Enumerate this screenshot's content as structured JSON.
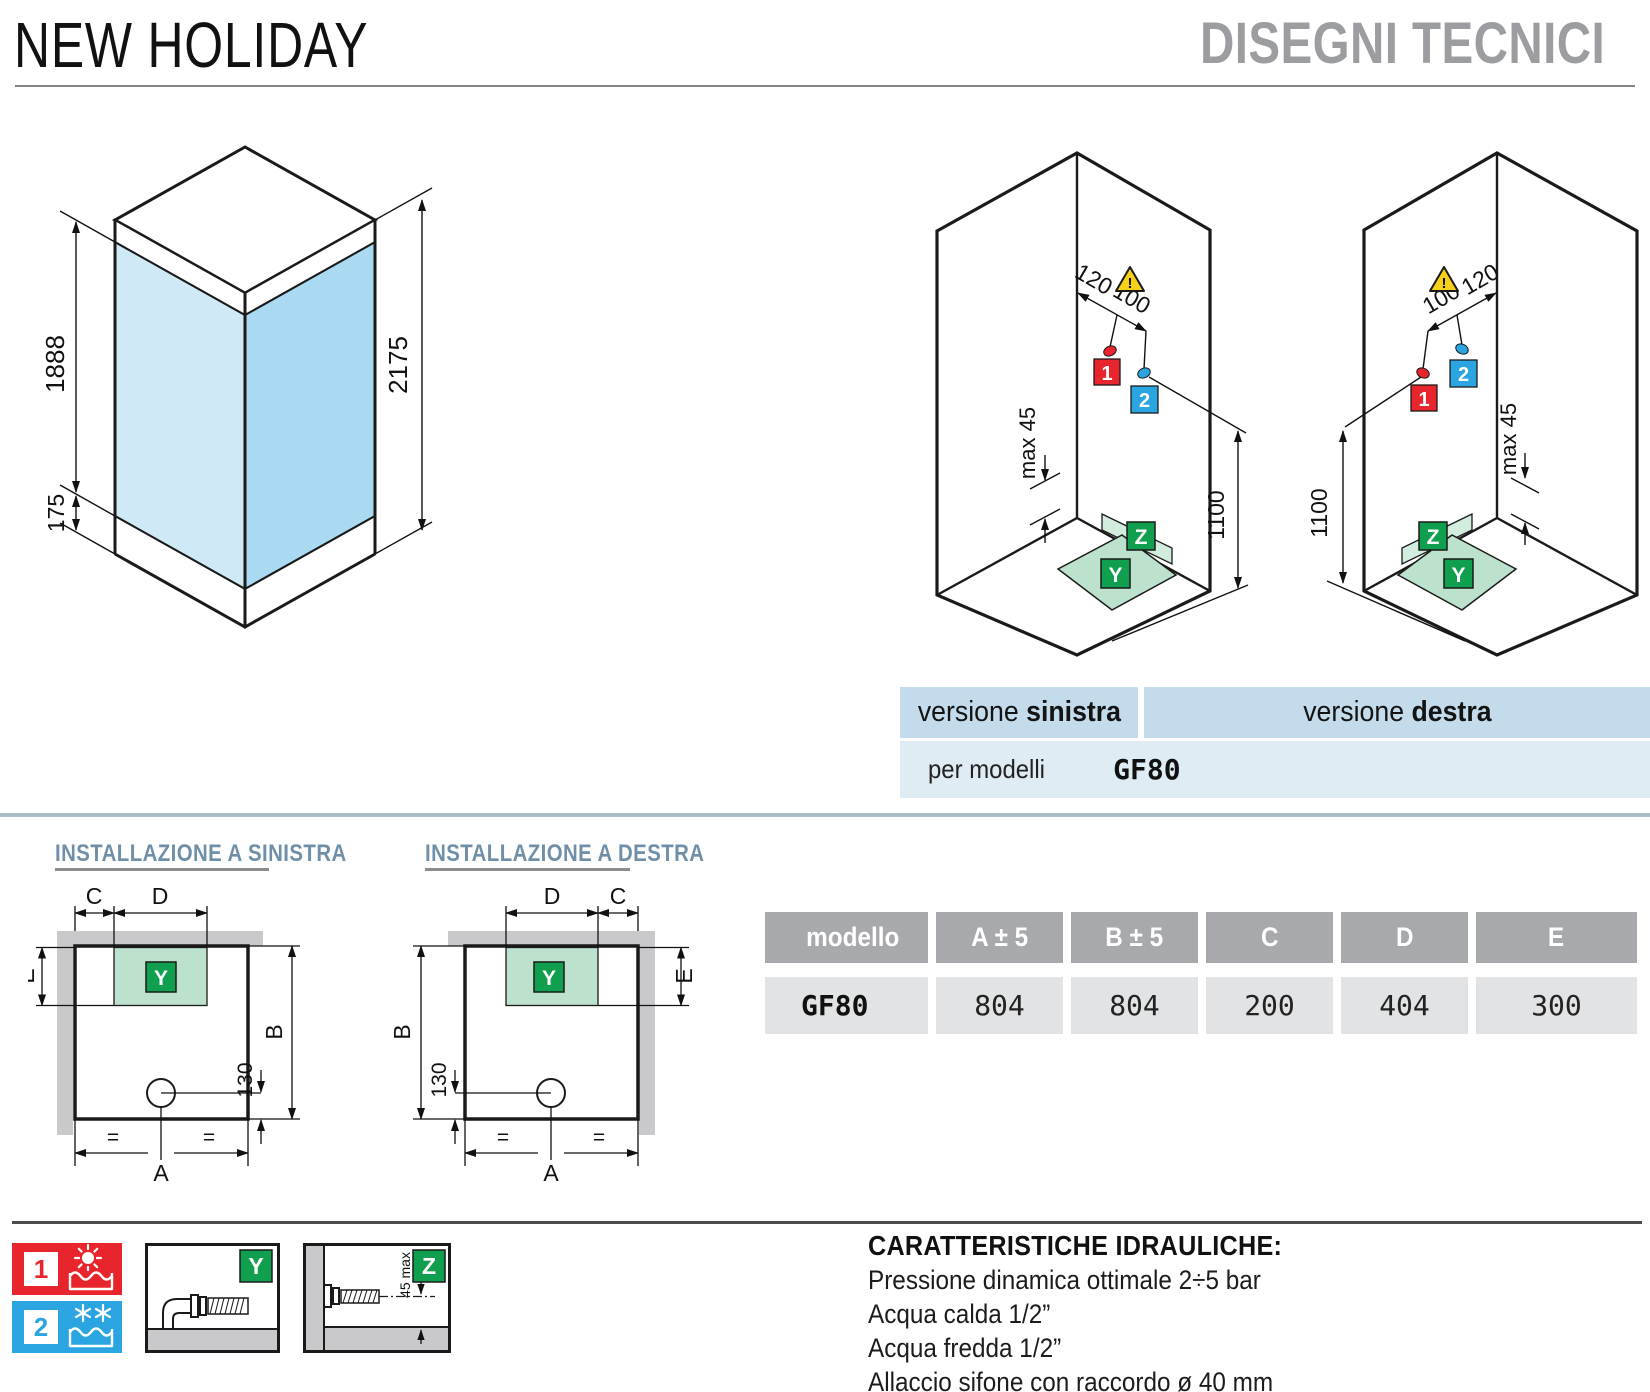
{
  "header": {
    "title": "NEW HOLIDAY",
    "subtitle": "DISEGNI TECNICI"
  },
  "cabin_diagram": {
    "height_glass": "1888",
    "height_tray": "175",
    "height_total": "2175"
  },
  "iso_diagrams": {
    "dim_a": "120",
    "dim_b": "100",
    "max45": "max 45",
    "height": "1100",
    "hot_tag": "1",
    "cold_tag": "2",
    "drain_tag": "Y",
    "wall_drain_tag": "Z",
    "warning": "!"
  },
  "versions": {
    "left_prefix": "versione",
    "left_name": "sinistra",
    "right_prefix": "versione",
    "right_name": "destra",
    "models_label": "per modelli",
    "models_value": "GF80"
  },
  "installation": {
    "left_title": "INSTALLAZIONE A SINISTRA",
    "right_title": "INSTALLAZIONE A DESTRA",
    "dim_a": "A",
    "dim_b": "B",
    "dim_c": "C",
    "dim_d": "D",
    "dim_e": "E",
    "dim_130": "130",
    "equal": "=",
    "drain_tag": "Y"
  },
  "table": {
    "headers": [
      "modello",
      "A ± 5",
      "B ± 5",
      "C",
      "D",
      "E"
    ],
    "row": {
      "model": "GF80",
      "a": "804",
      "b": "804",
      "c": "200",
      "d": "404",
      "e": "300"
    }
  },
  "legend": {
    "hot_tag": "1",
    "cold_tag": "2",
    "floor_tag": "Y",
    "wall_tag": "Z",
    "wall_dim": "45 max"
  },
  "hydraulics": {
    "title": "CARATTERISTICHE IDRAULICHE:",
    "line1": "Pressione dinamica ottimale 2÷5 bar",
    "line2": "Acqua calda 1/2”",
    "line3": "Acqua fredda 1/2”",
    "line4": "Allaccio sifone con raccordo ø 40 mm"
  },
  "colors": {
    "hot": "#e8252c",
    "cold": "#2ba5e1",
    "green": "#0f9f4f",
    "tray_green": "#bce1cd",
    "glass_left": "#cfe9f7",
    "glass_right": "#a9daf2",
    "bar_blue": "#c3dbea",
    "row_blue": "#dfecf4",
    "table_header_gray": "#a7a9ac",
    "table_row_gray": "#e2e3e4"
  }
}
